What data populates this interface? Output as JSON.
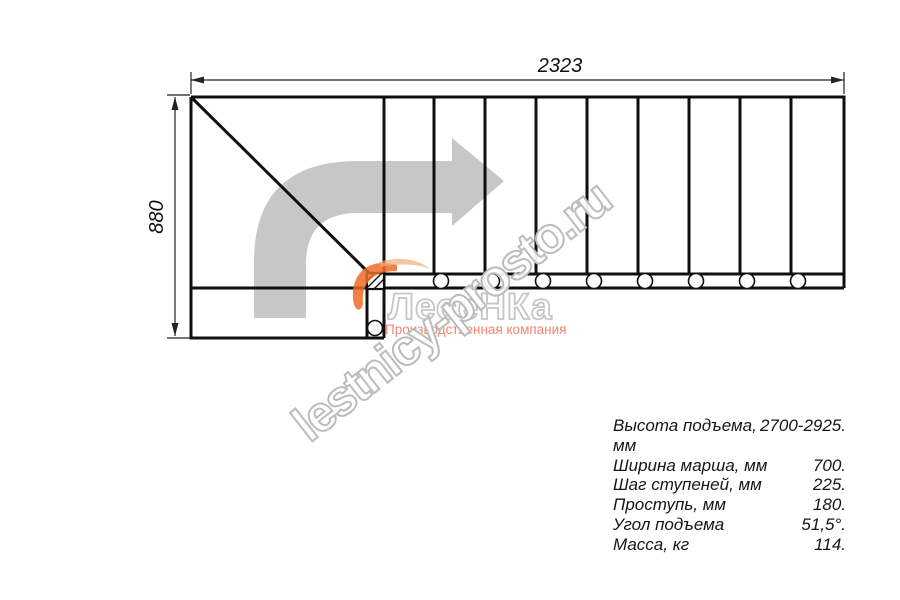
{
  "drawing": {
    "width_dim": "2323",
    "height_dim": "880"
  },
  "watermark": {
    "diagonal_text": "lestnicy-prosto.ru",
    "logo_text": "ЛесеНКа",
    "logo_subtitle": "Производственная компания"
  },
  "specs": {
    "rows": [
      {
        "label": "Высота подъема, мм",
        "value": "2700-2925."
      },
      {
        "label": "Ширина марша, мм",
        "value": "700."
      },
      {
        "label": "Шаг ступеней, мм",
        "value": "225."
      },
      {
        "label": "Проступь, мм",
        "value": "180."
      },
      {
        "label": "Угол подъема",
        "value": "51,5°."
      },
      {
        "label": "Масса, кг",
        "value": "114."
      }
    ]
  },
  "colors": {
    "line": "#0f0f0f",
    "direction_arrow": "#c7c7c7",
    "watermark_outline": "#bcbcbc",
    "logo_accent_orange": "#ed6b28",
    "logo_subtitle_red": "#ee6f5a",
    "background": "#ffffff"
  }
}
